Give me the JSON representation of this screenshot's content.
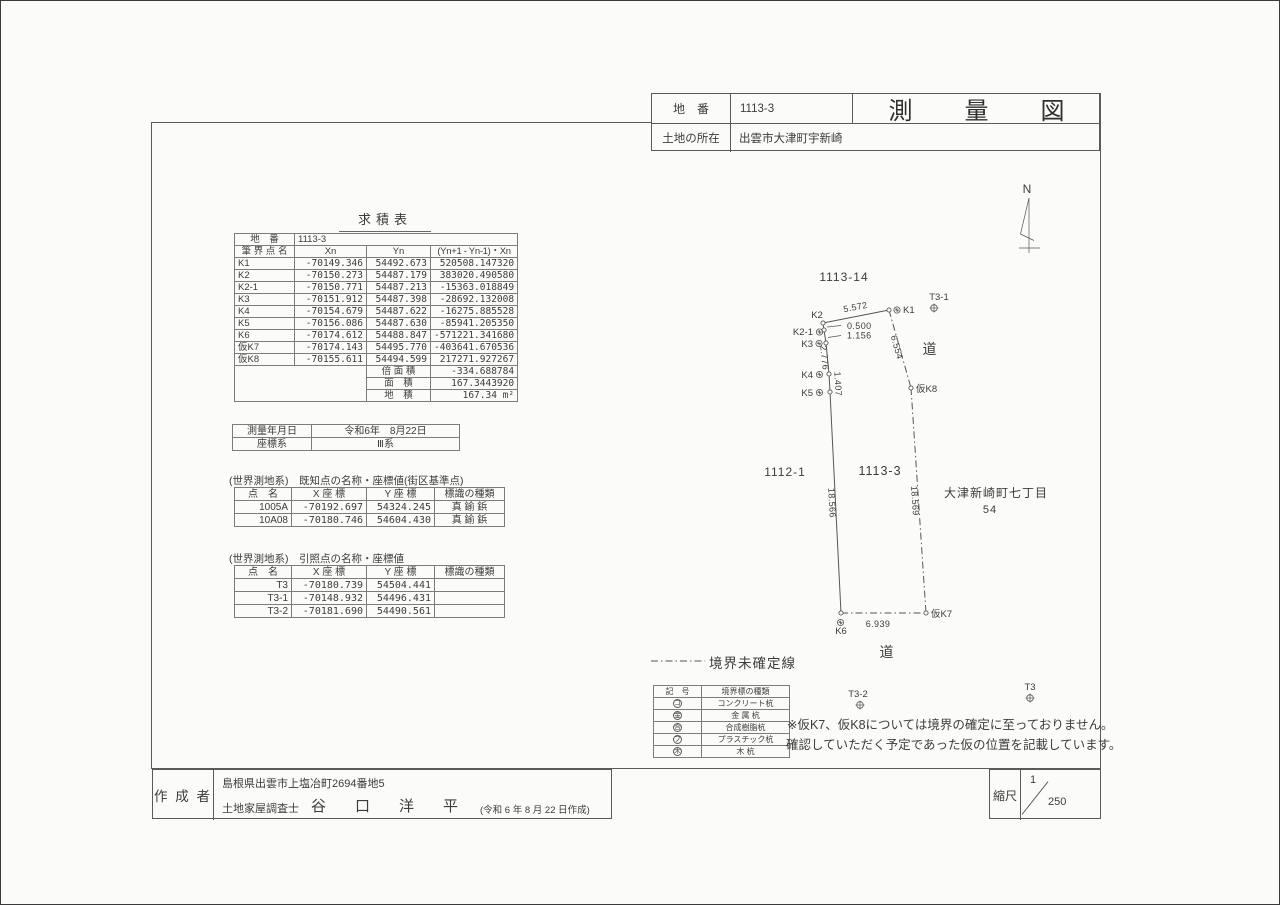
{
  "header": {
    "parcel_no_label": "地　番",
    "parcel_no": "1113-3",
    "title": "測量図",
    "location_label": "土地の所在",
    "location": "出雲市大津町宇新崎"
  },
  "area_table": {
    "title": "求積表",
    "parcel_label": "地　番",
    "parcel_number": "1113-3",
    "columns": [
      "筆 界 点 名",
      "Xn",
      "Yn",
      "(Yn+1 - Yn-1)・Xn"
    ],
    "rows": [
      [
        "K1",
        "-70149.346",
        "54492.673",
        "520508.147320"
      ],
      [
        "K2",
        "-70150.273",
        "54487.179",
        "383020.490580"
      ],
      [
        "K2-1",
        "-70150.771",
        "54487.213",
        "-15363.018849"
      ],
      [
        "K3",
        "-70151.912",
        "54487.398",
        "-28692.132008"
      ],
      [
        "K4",
        "-70154.679",
        "54487.622",
        "-16275.885528"
      ],
      [
        "K5",
        "-70156.086",
        "54487.630",
        "-85941.205350"
      ],
      [
        "K6",
        "-70174.612",
        "54488.847",
        "-571221.341680"
      ],
      [
        "仮K7",
        "-70174.143",
        "54495.770",
        "-403641.670536"
      ],
      [
        "仮K8",
        "-70155.611",
        "54494.599",
        "217271.927267"
      ]
    ],
    "footer_rows": [
      [
        "倍 面 積",
        "-334.688784"
      ],
      [
        "面　積",
        "167.3443920"
      ],
      [
        "地　積",
        "167.34 m²"
      ]
    ]
  },
  "survey_info": {
    "rows": [
      [
        "測量年月日",
        "令和6年　8月22日"
      ],
      [
        "座標系",
        "Ⅲ系"
      ]
    ]
  },
  "known_points": {
    "caption": "(世界測地系)　既知点の名称・座標値(街区基準点)",
    "columns": [
      "点　名",
      "X 座 標",
      "Y 座 標",
      "標識の種類"
    ],
    "rows": [
      [
        "1005A",
        "-70192.697",
        "54324.245",
        "真 鍮 鋲"
      ],
      [
        "10A08",
        "-70180.746",
        "54604.430",
        "真 鍮 鋲"
      ]
    ]
  },
  "reference_points": {
    "caption": "(世界測地系)　引照点の名称・座標値",
    "columns": [
      "点　名",
      "X 座 標",
      "Y 座 標",
      "標識の種類"
    ],
    "rows": [
      [
        "T3",
        "-70180.739",
        "54504.441",
        ""
      ],
      [
        "T3-1",
        "-70148.932",
        "54496.431",
        ""
      ],
      [
        "T3-2",
        "-70181.690",
        "54490.561",
        ""
      ]
    ]
  },
  "legend": {
    "line_label": "境界未確定線",
    "columns": [
      "記　号",
      "境界標の種類"
    ],
    "rows": [
      {
        "symbol": "コ",
        "label": "コンクリート杭"
      },
      {
        "symbol": "金",
        "label": "金 属 杭"
      },
      {
        "symbol": "合",
        "label": "合成樹脂杭"
      },
      {
        "symbol": "プ",
        "label": "プラスチック杭"
      },
      {
        "symbol": "木",
        "label": "木 杭"
      }
    ]
  },
  "note": {
    "line1": "※仮K7、仮K8については境界の確定に至っておりません。",
    "line2": "確認していただく予定であった仮の位置を記載しています。"
  },
  "drawing": {
    "north_label": "N",
    "points": [
      {
        "id": "K1",
        "x": 888,
        "y": 309
      },
      {
        "id": "K2",
        "x": 822,
        "y": 322
      },
      {
        "id": "K2-1",
        "x": 823,
        "y": 329
      },
      {
        "id": "K3",
        "x": 825,
        "y": 342
      },
      {
        "id": "K4",
        "x": 828,
        "y": 373
      },
      {
        "id": "K5",
        "x": 829,
        "y": 391
      },
      {
        "id": "K6",
        "x": 840,
        "y": 612
      },
      {
        "id": "仮K7",
        "x": 925,
        "y": 612
      },
      {
        "id": "仮K8",
        "x": 910,
        "y": 387
      }
    ],
    "segments": [
      {
        "a": "K2",
        "b": "K1",
        "dashed": false
      },
      {
        "a": "K2",
        "b": "K2-1",
        "dashed": false
      },
      {
        "a": "K2-1",
        "b": "K3",
        "dashed": false
      },
      {
        "a": "K3",
        "b": "K4",
        "dashed": false
      },
      {
        "a": "K4",
        "b": "K5",
        "dashed": false
      },
      {
        "a": "K5",
        "b": "K6",
        "dashed": false
      },
      {
        "a": "K1",
        "b": "仮K8",
        "dashed": true
      },
      {
        "a": "仮K8",
        "b": "仮K7",
        "dashed": true
      },
      {
        "a": "K6",
        "b": "仮K7",
        "dashed": true
      }
    ],
    "marker_symbols": [
      {
        "x": 896,
        "y": 309
      },
      {
        "x": 818.5,
        "y": 331
      },
      {
        "x": 818,
        "y": 342.5
      },
      {
        "x": 818.5,
        "y": 373.5
      },
      {
        "x": 818.5,
        "y": 391.5
      },
      {
        "x": 839.5,
        "y": 621.5
      }
    ],
    "ref_markers": [
      {
        "x": 933,
        "y": 307
      },
      {
        "x": 1029,
        "y": 697
      },
      {
        "x": 859,
        "y": 704
      }
    ],
    "point_labels": [
      {
        "text": "K1",
        "x": 902,
        "y": 312,
        "anchor": "start"
      },
      {
        "text": "K2",
        "x": 816,
        "y": 317,
        "anchor": "middle"
      },
      {
        "text": "K2-1",
        "x": 812,
        "y": 334,
        "anchor": "end"
      },
      {
        "text": "K3",
        "x": 812,
        "y": 346,
        "anchor": "end"
      },
      {
        "text": "K4",
        "x": 812,
        "y": 377,
        "anchor": "end"
      },
      {
        "text": "K5",
        "x": 812,
        "y": 395,
        "anchor": "end"
      },
      {
        "text": "K6",
        "x": 840,
        "y": 633,
        "anchor": "middle"
      },
      {
        "text": "仮K7",
        "x": 930,
        "y": 616,
        "anchor": "start"
      },
      {
        "text": "仮K8",
        "x": 915,
        "y": 391,
        "anchor": "start"
      },
      {
        "text": "T3-1",
        "x": 938,
        "y": 299,
        "anchor": "middle"
      },
      {
        "text": "T3",
        "x": 1029,
        "y": 689,
        "anchor": "middle"
      },
      {
        "text": "T3-2",
        "x": 857,
        "y": 696,
        "anchor": "middle"
      }
    ],
    "dimensions": [
      {
        "text": "5.572",
        "x": 855,
        "y": 309,
        "rot": -11
      },
      {
        "text": "0.500",
        "x": 846,
        "y": 328,
        "rot": 0,
        "anchor": "start"
      },
      {
        "text": "1.156",
        "x": 846,
        "y": 337.5,
        "rot": 0,
        "anchor": "start"
      },
      {
        "text": "2.776",
        "x": 820.5,
        "y": 357,
        "rot": 84
      },
      {
        "text": "1.407",
        "x": 834,
        "y": 383,
        "rot": 87
      },
      {
        "text": "18.566",
        "x": 828,
        "y": 502,
        "rot": 87
      },
      {
        "text": "6.554",
        "x": 893,
        "y": 347,
        "rot": 74
      },
      {
        "text": "18.569",
        "x": 911,
        "y": 500,
        "rot": 86
      },
      {
        "text": "6.939",
        "x": 877,
        "y": 626,
        "rot": 0
      }
    ],
    "leaders": [
      [
        840,
        324.5,
        826,
        326
      ],
      [
        840,
        334.5,
        827,
        336.5
      ]
    ],
    "area_labels": [
      {
        "text": "1113-14",
        "x": 843,
        "y": 280,
        "size": 12
      },
      {
        "text": "1112-1",
        "x": 784,
        "y": 475,
        "size": 12
      },
      {
        "text": "1113-3",
        "x": 879,
        "y": 474,
        "size": 12.5
      },
      {
        "text": "大津新崎町七丁目",
        "x": 995,
        "y": 496,
        "size": 12
      },
      {
        "text": "54",
        "x": 989,
        "y": 512,
        "size": 11
      },
      {
        "text": "道",
        "x": 929,
        "y": 353,
        "size": 14
      },
      {
        "text": "道",
        "x": 886,
        "y": 656,
        "size": 14
      }
    ]
  },
  "footer": {
    "author_label": "作 成 者",
    "address": "島根県出雲市上塩冶町2694番地5",
    "surveyor_title": "土地家屋調査士",
    "surveyor_name": "谷　口　洋　平",
    "created_note": "(令和 6 年 8 月 22 日作成)",
    "scale_label": "縮尺",
    "scale_numerator": "1",
    "scale_denominator": "250"
  }
}
